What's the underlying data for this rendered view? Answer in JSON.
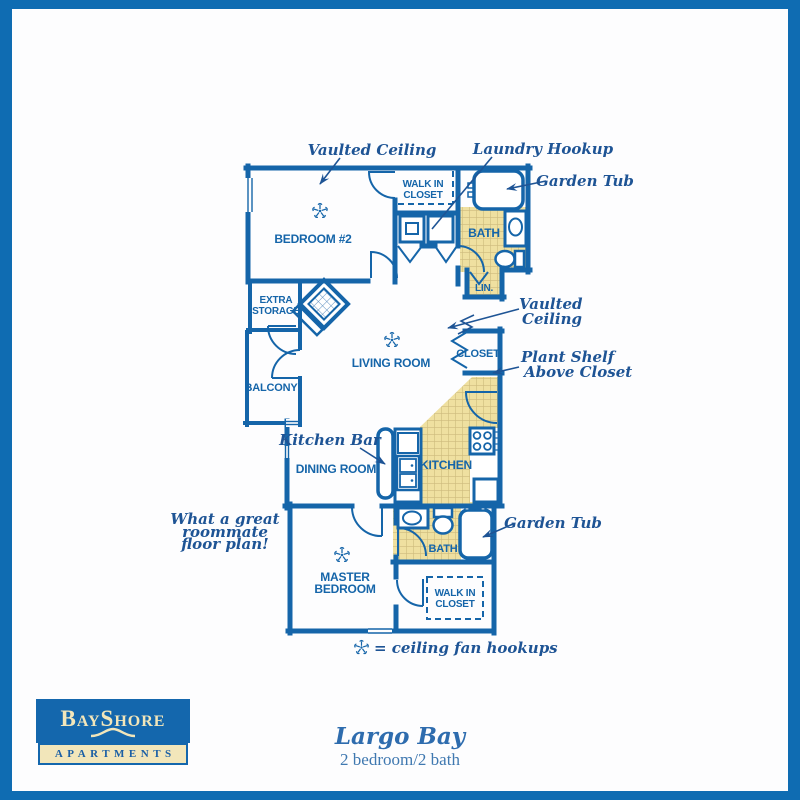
{
  "page": {
    "background": "#fdfdfe",
    "frame_color": "#0f6cb2"
  },
  "plan": {
    "colors": {
      "wall": "#1565a9",
      "annotation": "#1e5495",
      "tile_fill": "#efe0a0",
      "tile_grid": "#cdbb7c"
    },
    "rooms": {
      "bedroom2": "BEDROOM #2",
      "walk_in_closet_top": {
        "line1": "WALK IN",
        "line2": "CLOSET"
      },
      "bath_top": "BATH",
      "linen": "LIN.",
      "extra_storage": {
        "line1": "EXTRA",
        "line2": "STORAGE"
      },
      "balcony": "BALCONY",
      "living_room": "LIVING ROOM",
      "closet": "CLOSET",
      "dining_room": "DINING ROOM",
      "kitchen": "KITCHEN",
      "bath_bottom": "BATH",
      "master_bedroom": {
        "line1": "MASTER",
        "line2": "BEDROOM"
      },
      "walk_in_closet_bottom": {
        "line1": "WALK IN",
        "line2": "CLOSET"
      }
    },
    "annotations": {
      "vaulted_ceiling_top": "Vaulted Ceiling",
      "laundry_hookup": "Laundry Hookup",
      "garden_tub_top": "Garden Tub",
      "vaulted_ceiling_right": {
        "line1": "Vaulted",
        "line2": "Ceiling"
      },
      "plant_shelf": {
        "line1": "Plant Shelf",
        "line2": "Above Closet"
      },
      "kitchen_bar": "Kitchen Bar",
      "garden_tub_bottom": "Garden Tub",
      "roommate_note": {
        "line1": "What a great",
        "line2": "roommate",
        "line3": "floor plan!"
      },
      "legend_text": "= ceiling fan hookups"
    }
  },
  "branding": {
    "logo": {
      "b": "B",
      "ay": "AY",
      "s": "S",
      "hore": "HORE",
      "apartments": "APARTMENTS",
      "box_color": "#1467ad",
      "cream_color": "#f2e6ba"
    },
    "plan_name": "Largo Bay",
    "plan_spec": "2 bedroom/2 bath"
  }
}
